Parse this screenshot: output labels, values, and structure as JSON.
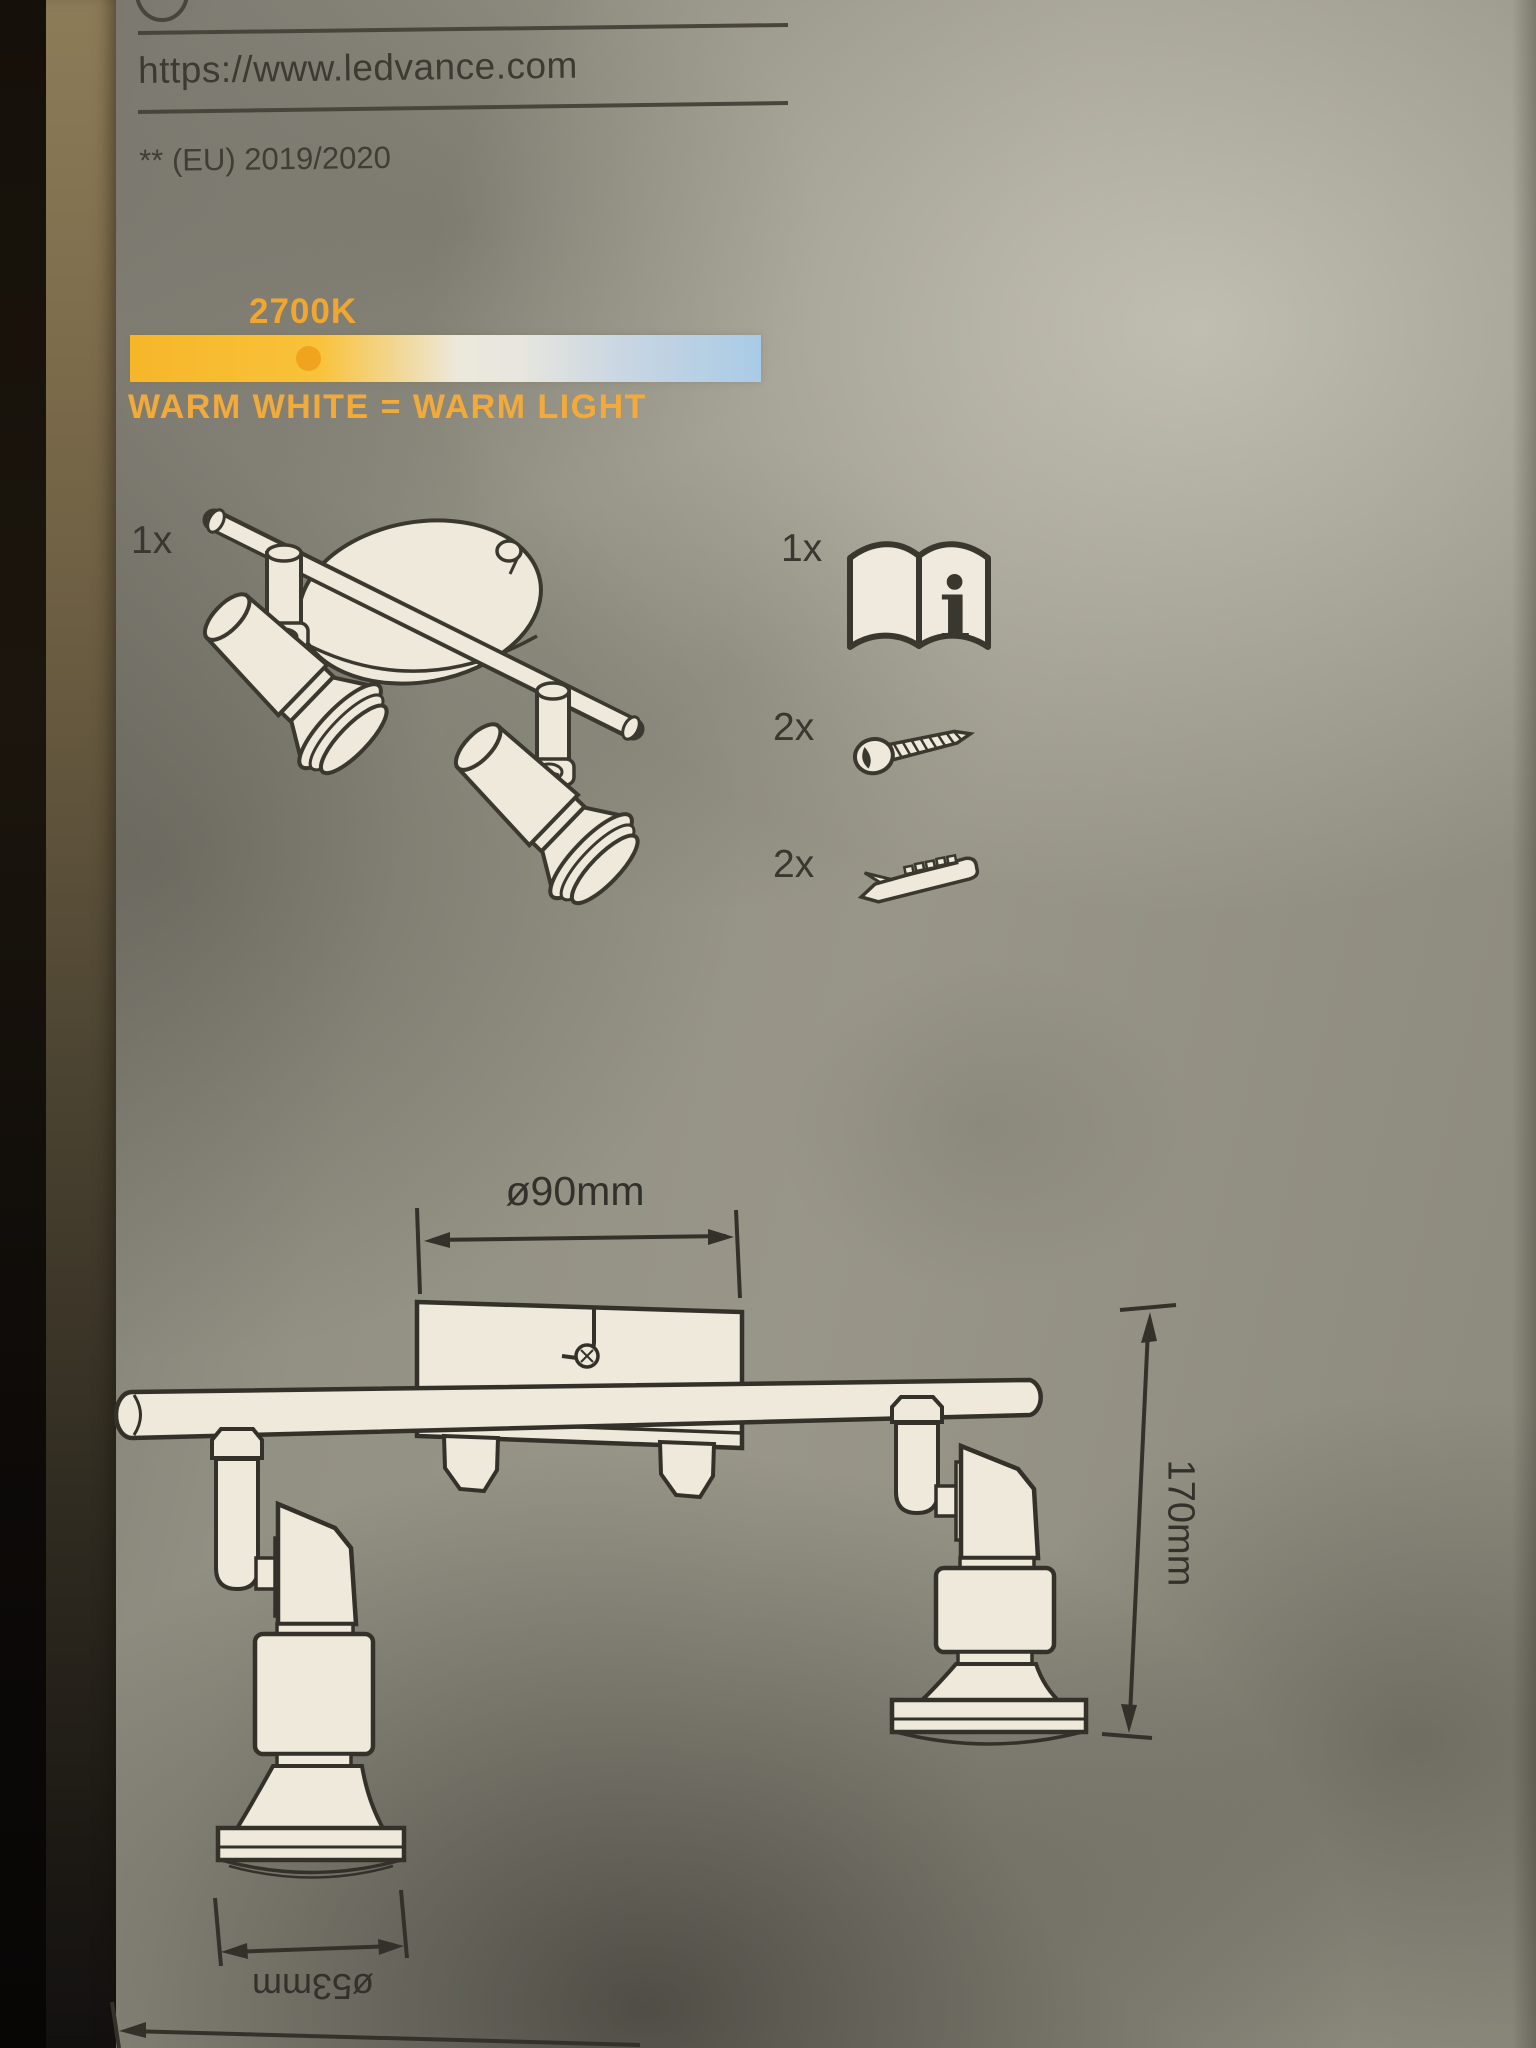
{
  "header": {
    "url": "https://www.ledvance.com",
    "regulation_note": "** (EU) 2019/2020"
  },
  "color_temperature": {
    "kelvin_label": "2700K",
    "description": "WARM WHITE = WARM LIGHT",
    "label_color": "#f0a62f",
    "scale_warm_color": "#f6b62a",
    "scale_mid_color": "#ece8dc",
    "scale_cool_color": "#a9cbe6",
    "marker_color": "#f0a31c",
    "marker_position_pct": 26.5
  },
  "contents": {
    "fixture": {
      "qty": "1x",
      "icon": "two-spot-ceiling-light-illustration"
    },
    "items": [
      {
        "qty": "1x",
        "icon": "manual-book-icon",
        "glyph": "i"
      },
      {
        "qty": "2x",
        "icon": "screw-icon"
      },
      {
        "qty": "2x",
        "icon": "wall-plug-icon"
      }
    ]
  },
  "dimensions": {
    "canopy_diameter": "ø90mm",
    "height": "170mm",
    "spot_diameter": "ø53mm"
  }
}
